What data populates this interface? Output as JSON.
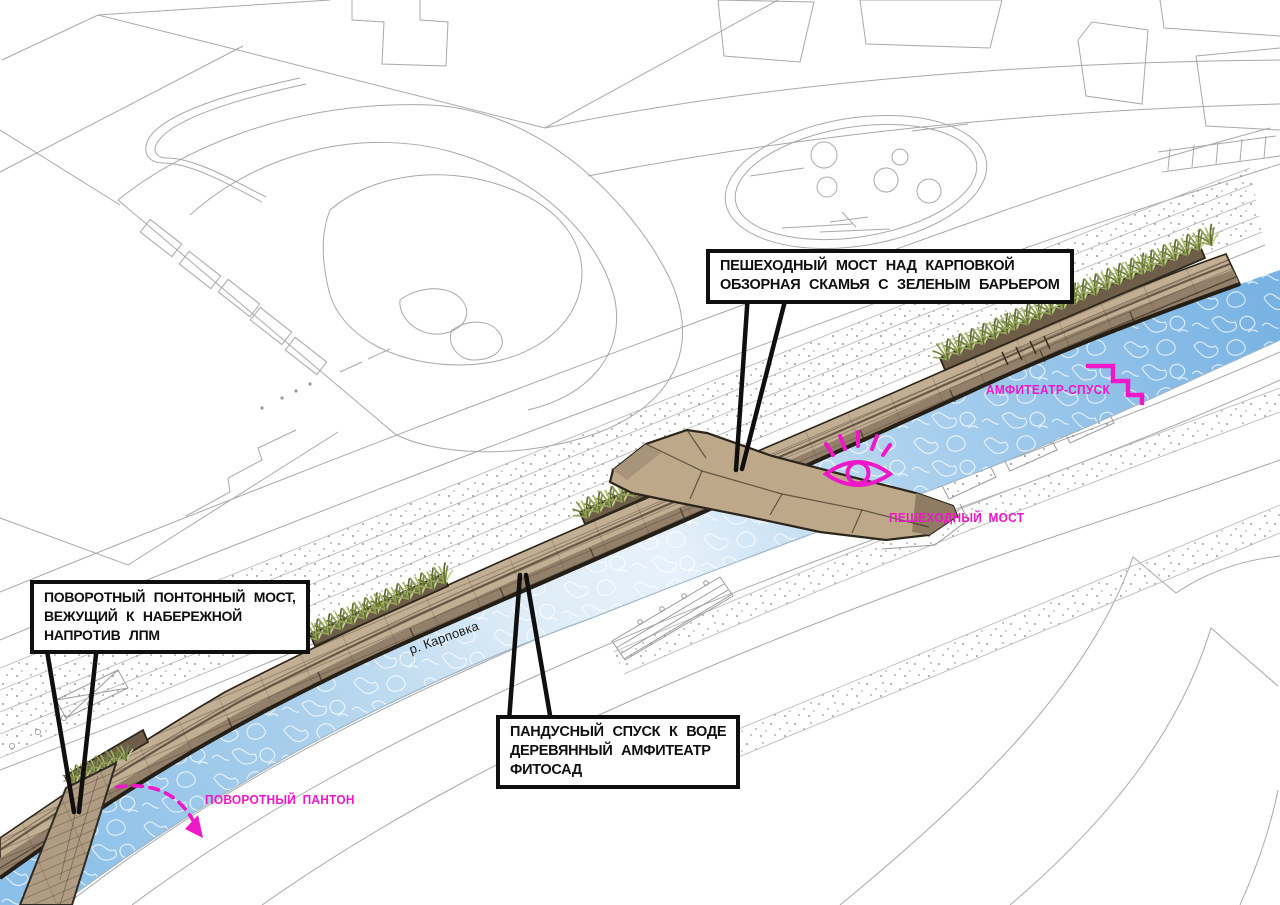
{
  "diagram": {
    "type": "landscape-masterplan-annotation",
    "callouts": [
      {
        "id": "pedestrian-bridge",
        "lines": [
          "ПЕШЕХОДНЫЙ МОСТ НАД КАРПОВКОЙ",
          "ОБЗОРНАЯ СКАМЬЯ С ЗЕЛЕНЫМ БАРЬЕРОМ"
        ]
      },
      {
        "id": "pontoon-bridge",
        "lines": [
          "ПОВОРОТНЫЙ ПОНТОННЫЙ МОСТ,",
          "ВЕЖУЩИЙ К НАБЕРЕЖНОЙ",
          "НАПРОТИВ ЛПМ"
        ]
      },
      {
        "id": "ramp-descent",
        "lines": [
          "ПАНДУСНЫЙ СПУСК К ВОДЕ",
          "ДЕРЕВЯННЫЙ АМФИТЕАТР",
          "ФИТОСАД"
        ]
      }
    ],
    "labels": {
      "amphitheater_descent": "АМФИТЕАТР-СПУСК",
      "pedestrian_bridge": "ПЕШЕХОДНЫЙ МОСТ",
      "rotating_pontoon": "ПОВОРОТНЫЙ ПАНТОН",
      "river": "р. Карповка"
    },
    "icons": {
      "eye": "eye-icon",
      "stairs": "stairs-icon",
      "rotation_arrow": "rotation-arrow-icon"
    },
    "colors": {
      "magenta": "#ee18c8",
      "ink": "#0f0f0f",
      "water-deep": "#7db7e6",
      "water-pale": "#eaf3fb",
      "wood-deck": "#c2ae93",
      "wood-face": "#93806a",
      "wood-dark": "#241e15",
      "line-gray": "#a8a8a8"
    }
  }
}
